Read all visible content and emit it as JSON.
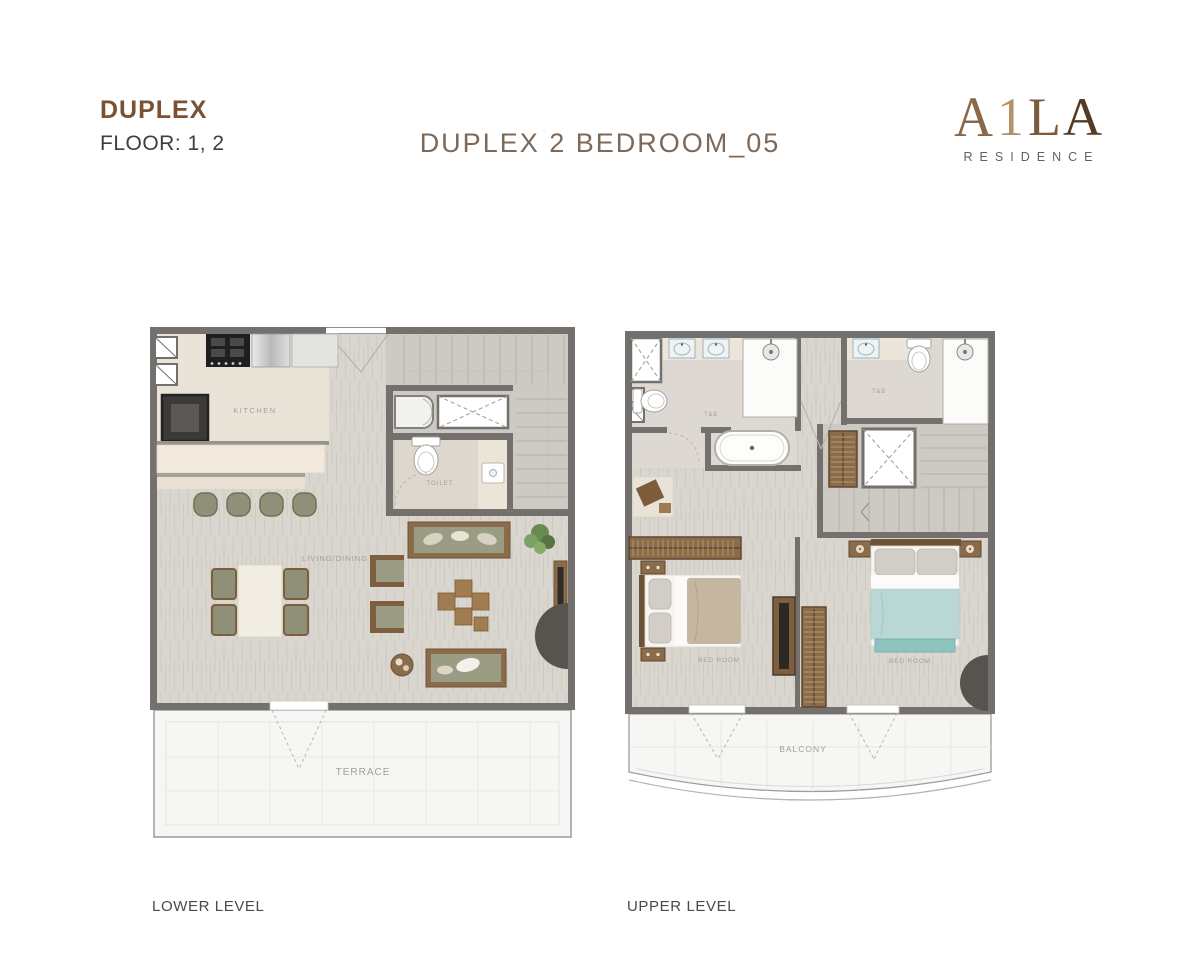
{
  "header": {
    "unit_type": "DUPLEX",
    "floor": "FLOOR: 1, 2",
    "title": "DUPLEX 2 BEDROOM_05"
  },
  "logo": {
    "letters": [
      "A",
      "1",
      "L",
      "A"
    ],
    "subtitle": "RESIDENCE"
  },
  "lower_plan": {
    "caption": "LOWER LEVEL",
    "labels": {
      "kitchen": "KITCHEN",
      "toilet": "TOILET",
      "living_dining": "LIVING/DINING",
      "terrace": "TERRACE"
    }
  },
  "upper_plan": {
    "caption": "UPPER LEVEL",
    "labels": {
      "bath_left": "T&B",
      "bath_right": "T&B",
      "bedroom_left": "BED ROOM",
      "bedroom_right": "BED ROOM",
      "balcony": "BALCONY"
    }
  },
  "colors": {
    "accent_brown": "#7a5133",
    "title_taupe": "#7d695a",
    "wall": "#73706d",
    "floor_wood": "#d9d5cf",
    "floor_beige": "#eae4d8",
    "floor_stairs": "#cdc9c3",
    "terrace_tile": "#f6f6f4",
    "furniture_wood": "#8a6b4a",
    "upholstery_olive": "#9b9c84",
    "bed_blanket_blue": "#b9d7d5",
    "feature_dark": "#56544f"
  }
}
